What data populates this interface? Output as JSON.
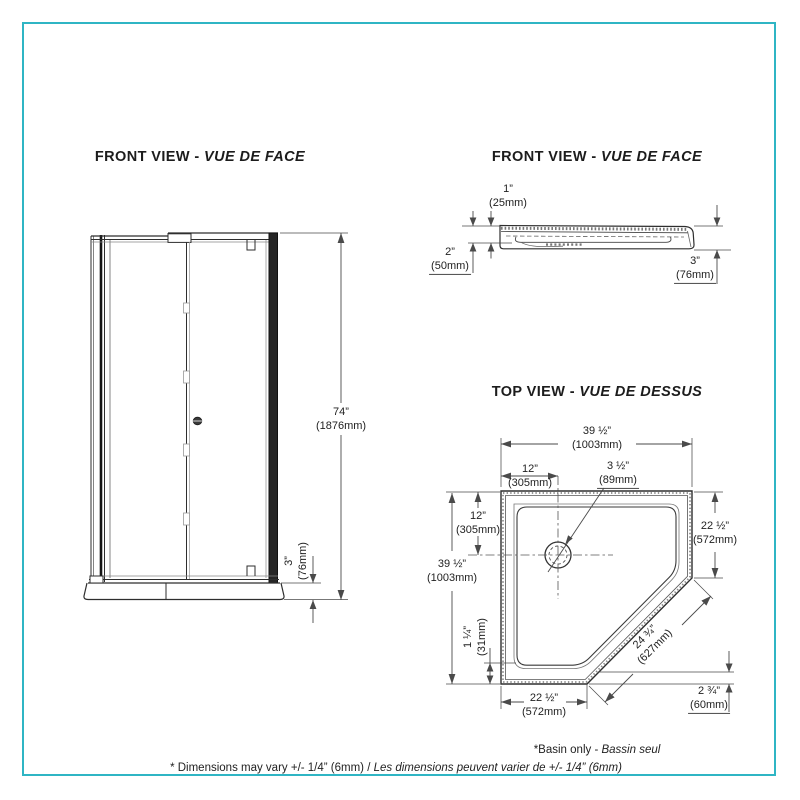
{
  "colors": {
    "frame_border": "#2fb5c4",
    "line_dark": "#2e2e2e",
    "dim_line": "#4a4a4a"
  },
  "views": {
    "door_front": {
      "title_en": "FRONT VIEW",
      "title_sep": " - ",
      "title_fr": "VUE DE FACE",
      "dims": {
        "height_in": "74”",
        "height_mm": "(1876mm)",
        "base_in": "3”",
        "base_mm": "(76mm)"
      }
    },
    "basin_front": {
      "title_en": "FRONT VIEW",
      "title_sep": " - ",
      "title_fr": "VUE DE FACE",
      "dims": {
        "flange_in": "1”",
        "flange_mm": "(25mm)",
        "left_in": "2”",
        "left_mm": "(50mm)",
        "right_in": "3”",
        "right_mm": "(76mm)"
      }
    },
    "basin_top": {
      "title_en": "TOP VIEW",
      "title_sep": " - ",
      "title_fr": "VUE DE DESSUS",
      "dims": {
        "width_in": "39 ½”",
        "width_mm": "(1003mm)",
        "drain_x_in": "12”",
        "drain_x_mm": "(305mm)",
        "drain_dia_in": "3 ½”",
        "drain_dia_mm": "(89mm)",
        "drain_y_in": "12”",
        "drain_y_mm": "(305mm)",
        "depth_in": "39 ½”",
        "depth_mm": "(1003mm)",
        "right_side_in": "22 ½”",
        "right_side_mm": "(572mm)",
        "rim_in": "1 ¼”",
        "rim_mm": "(31mm)",
        "bottom_in": "22 ½”",
        "bottom_mm": "(572mm)",
        "diagonal_in": "24 ¾”",
        "diagonal_mm": "(627mm)",
        "corner_in": "2 ¾”",
        "corner_mm": "(60mm)"
      }
    }
  },
  "notes": {
    "basin_note_en": "*Basin only - ",
    "basin_note_fr": "Bassin seul",
    "footer_en": "* Dimensions may vary +/- 1/4” (6mm) / ",
    "footer_fr": "Les dimensions peuvent varier de +/- 1/4” (6mm)"
  }
}
